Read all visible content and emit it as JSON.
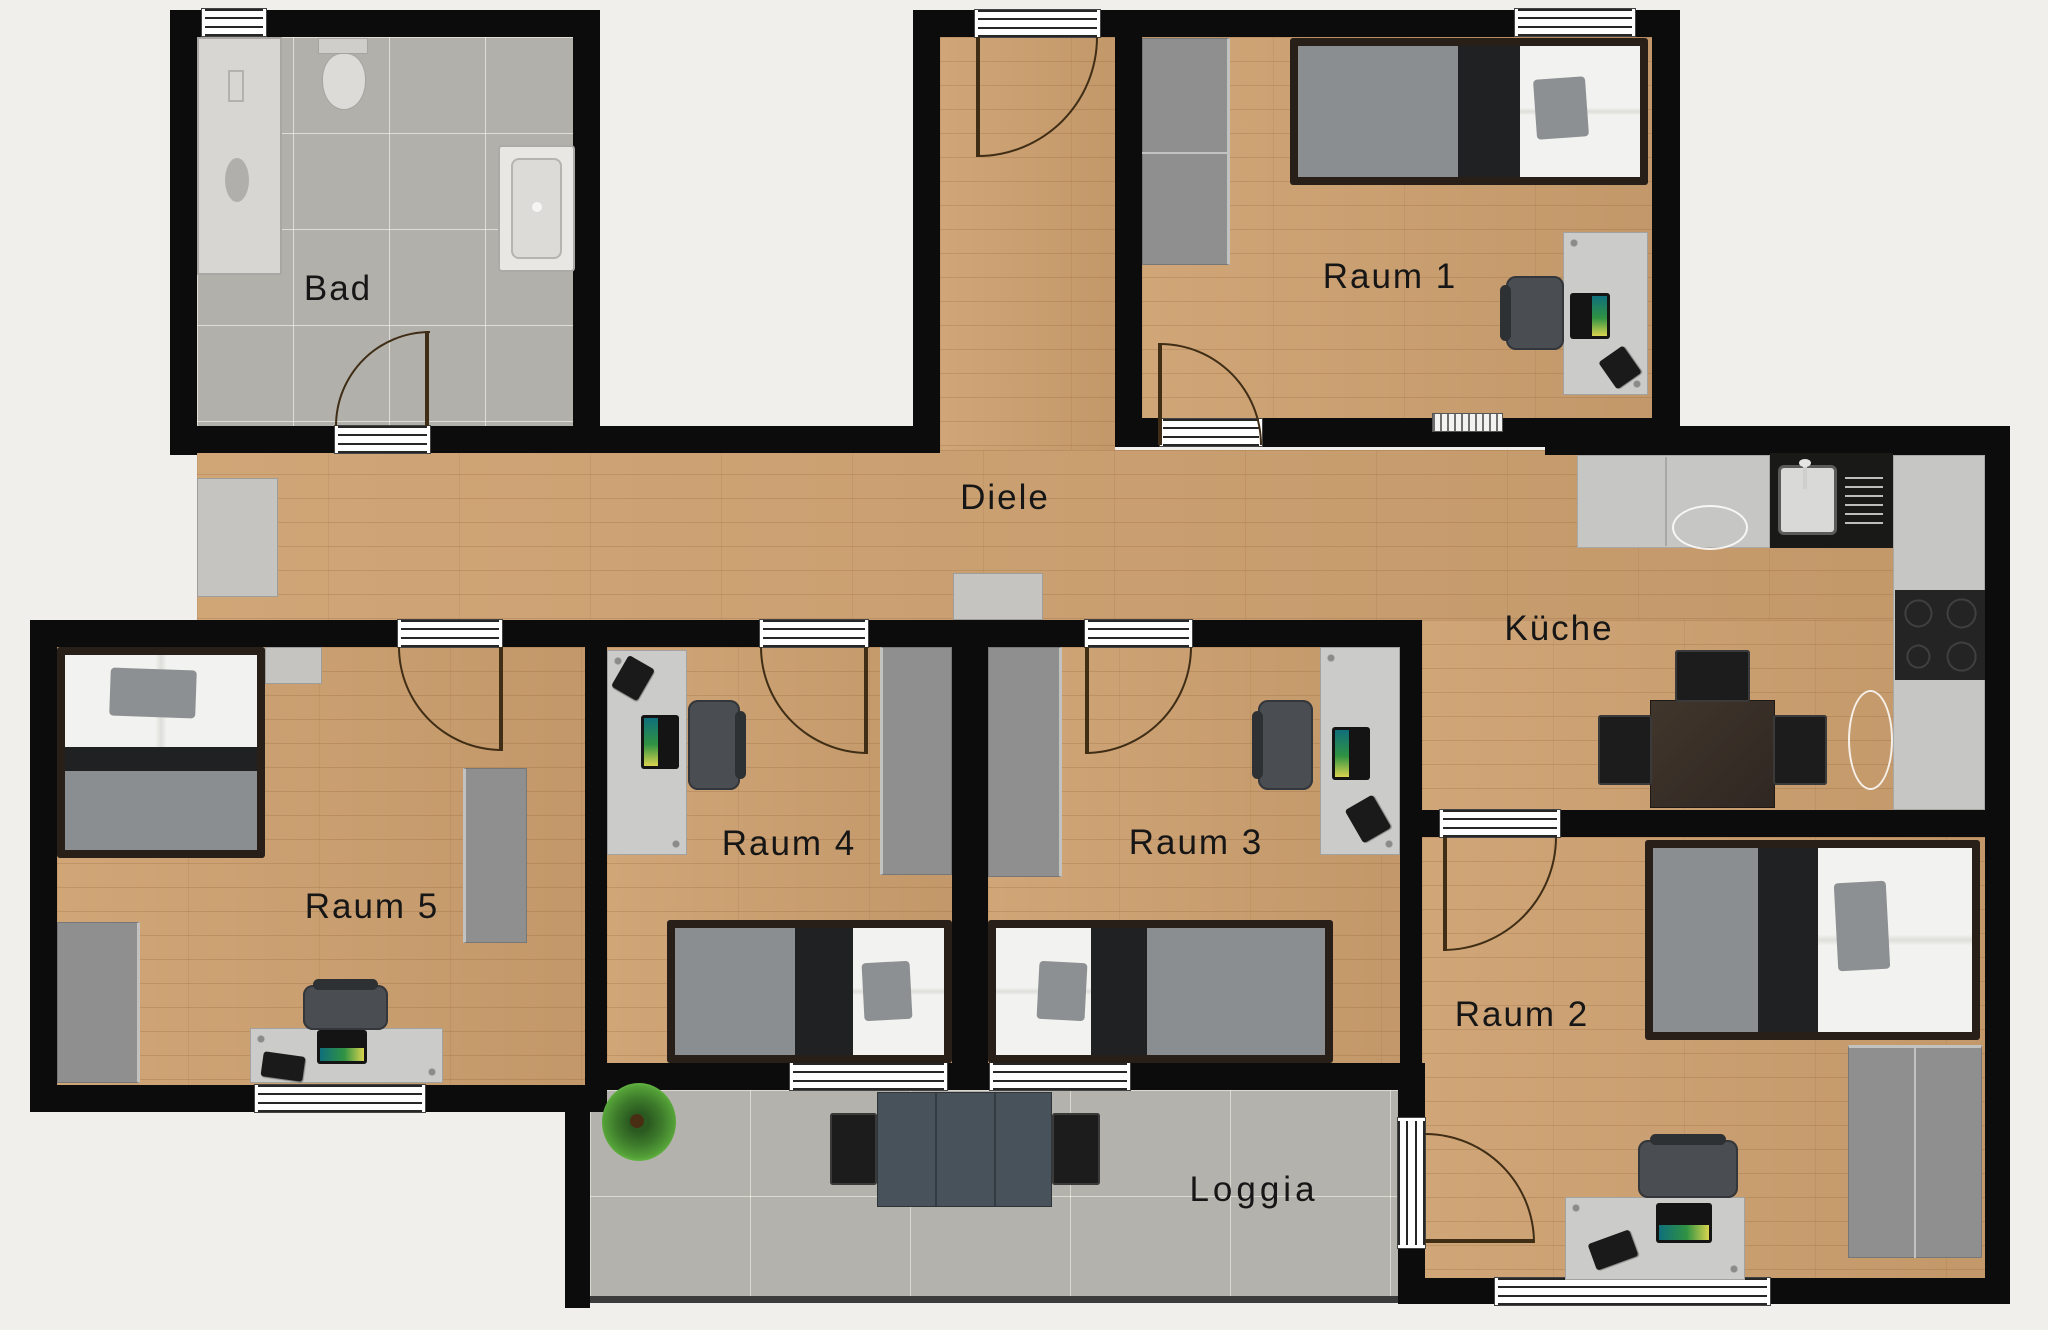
{
  "app": {
    "type": "apartment floor plan",
    "language": "German"
  },
  "rooms": [
    {
      "id": "bad",
      "label": "Bad"
    },
    {
      "id": "diele",
      "label": "Diele"
    },
    {
      "id": "raum1",
      "label": "Raum 1"
    },
    {
      "id": "kueche",
      "label": "Küche"
    },
    {
      "id": "raum2",
      "label": "Raum 2"
    },
    {
      "id": "raum3",
      "label": "Raum 3"
    },
    {
      "id": "raum4",
      "label": "Raum 4"
    },
    {
      "id": "raum5",
      "label": "Raum 5"
    },
    {
      "id": "loggia",
      "label": "Loggia"
    }
  ],
  "furniture": {
    "bad": [
      "shower",
      "toilet",
      "bathtub",
      "door"
    ],
    "raum1": [
      "wardrobe",
      "double-bed",
      "desk",
      "office-chair",
      "laptop",
      "phone",
      "radiator",
      "window"
    ],
    "raum2": [
      "double-bed",
      "wardrobe",
      "desk",
      "office-chair",
      "laptop",
      "phone",
      "window",
      "balcony-door"
    ],
    "raum3": [
      "wardrobe",
      "single-bed",
      "desk",
      "office-chair",
      "laptop",
      "phone",
      "window"
    ],
    "raum4": [
      "desk",
      "office-chair",
      "laptop",
      "phone",
      "wardrobe",
      "single-bed",
      "window"
    ],
    "raum5": [
      "double-bed",
      "dresser",
      "wardrobe",
      "wardrobe",
      "desk",
      "office-chair",
      "laptop",
      "phone",
      "window"
    ],
    "kueche": [
      "counter",
      "sink",
      "cooktop",
      "dining-table",
      "chair",
      "chair",
      "chair"
    ],
    "diele": [
      "sideboard",
      "sideboard",
      "entrance-door"
    ],
    "loggia": [
      "table",
      "chair",
      "chair",
      "plant"
    ]
  },
  "colors": {
    "background": "#f0efeb",
    "wall": "#0c0c0c",
    "wood_floor": "#cda06f",
    "tile_floor": "#b2b0aa",
    "wardrobe_gray": "#8f8f8f",
    "desk_gray": "#cbcbc9",
    "bed_white": "#f2f2f0",
    "bed_blanket_black": "#1f2123",
    "bed_mattress_gray": "#8b8e90",
    "kitchen_sink_dark": "#191917",
    "laptop_screen": "#2f9242",
    "label_text": "#161616"
  }
}
